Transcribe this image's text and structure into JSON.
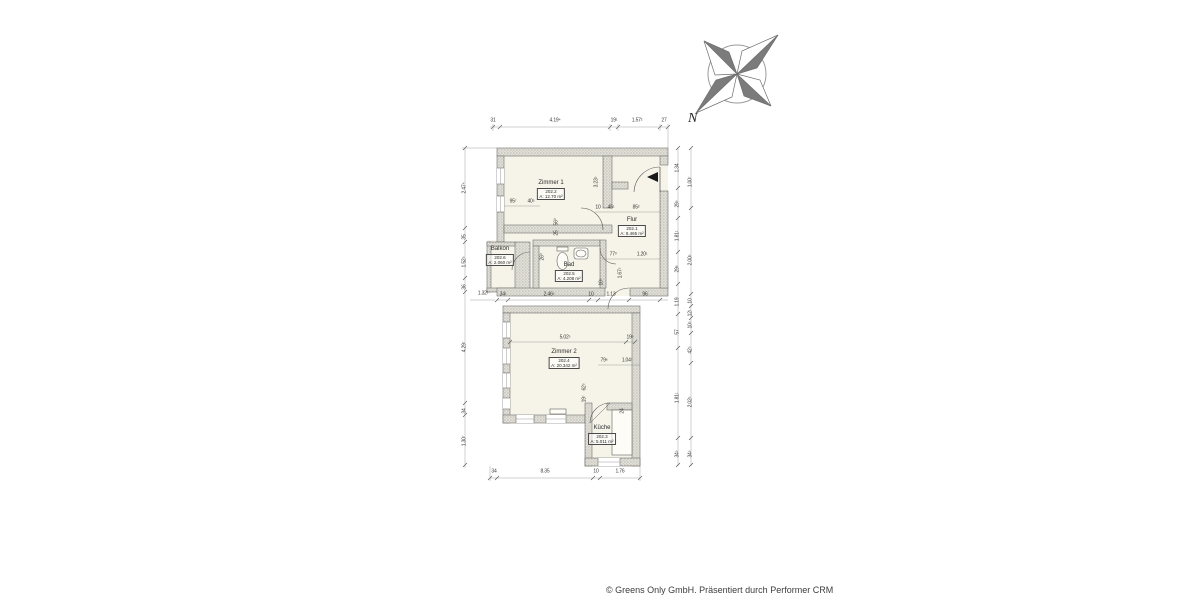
{
  "meta": {
    "footer": "© Greens Only GmbH. Präsentiert durch Performer CRM"
  },
  "compass": {
    "north_label": "N"
  },
  "rooms": {
    "zimmer1": {
      "name": "Zimmer 1",
      "nr": "202.2",
      "area": "A: 12.70 m²"
    },
    "flur": {
      "name": "Flur",
      "nr": "202.1",
      "area": "A: 8.465 m²"
    },
    "balkon": {
      "name": "Balkon",
      "nr": "202.6",
      "area": "A: 2.060 m²"
    },
    "bad": {
      "name": "Bad",
      "nr": "202.5",
      "area": "A: 4.208 m²"
    },
    "zimmer2": {
      "name": "Zimmer 2",
      "nr": "202.4",
      "area": "A: 20.342 m²"
    },
    "kueche": {
      "name": "Küche",
      "nr": "202.3",
      "area": "A: 5.011 m²"
    }
  },
  "dims": {
    "t1": "31",
    "t2": "4.19⁴",
    "t3": "19¹",
    "t4": "1.57²",
    "t5": "27",
    "m1": "34¹",
    "m2": "2.46⁵",
    "m3": "10",
    "m4": "1.13",
    "m5": "96",
    "b1": "34",
    "b2": "8.35",
    "b3": "10",
    "b4": "1.76",
    "l1": "2.47⁴",
    "l2": "35",
    "l3": "1.52⁹",
    "l4": "36",
    "l5": "4.29⁷",
    "l6": "34",
    "l7": "1.30⁷",
    "l8": "1.32¹",
    "r1": "1.34",
    "r2": "29⁵",
    "r3": "1.81¹",
    "r4": "29⁶",
    "r5": "1.19",
    "r6": "57",
    "r7": "1.81¹",
    "r8": "34⁵",
    "q1": "1.00⁷",
    "q2": "10",
    "q3": "12¹",
    "q4": "10⁵",
    "q5": "42⁵",
    "q6": "2.02⁵",
    "q7": "2.00⁵",
    "q8": "34⁵",
    "i1": "3.23⁵",
    "i2": "95⁷",
    "i3": "40⁵",
    "i4": "10",
    "i5": "45¹",
    "i6": "85²",
    "i7": "56⁰",
    "i8": "25",
    "i9": "26⁰",
    "i10": "77³",
    "i11": "1.20¹",
    "i12": "1.67⁵",
    "i13": "10⁵",
    "i14": "5.02⁵",
    "i15": "19⁵",
    "i16": "79⁶",
    "i17": "1.04⁷",
    "i18": "62⁵",
    "i19": "19⁷",
    "i20": "24"
  },
  "colors": {
    "wall_fill": "#e2e0d6",
    "wall_stroke": "#6e6e6e",
    "room_fill": "#f6f4e9",
    "dim_line": "#8a8a8a",
    "text": "#3a3a3a"
  }
}
